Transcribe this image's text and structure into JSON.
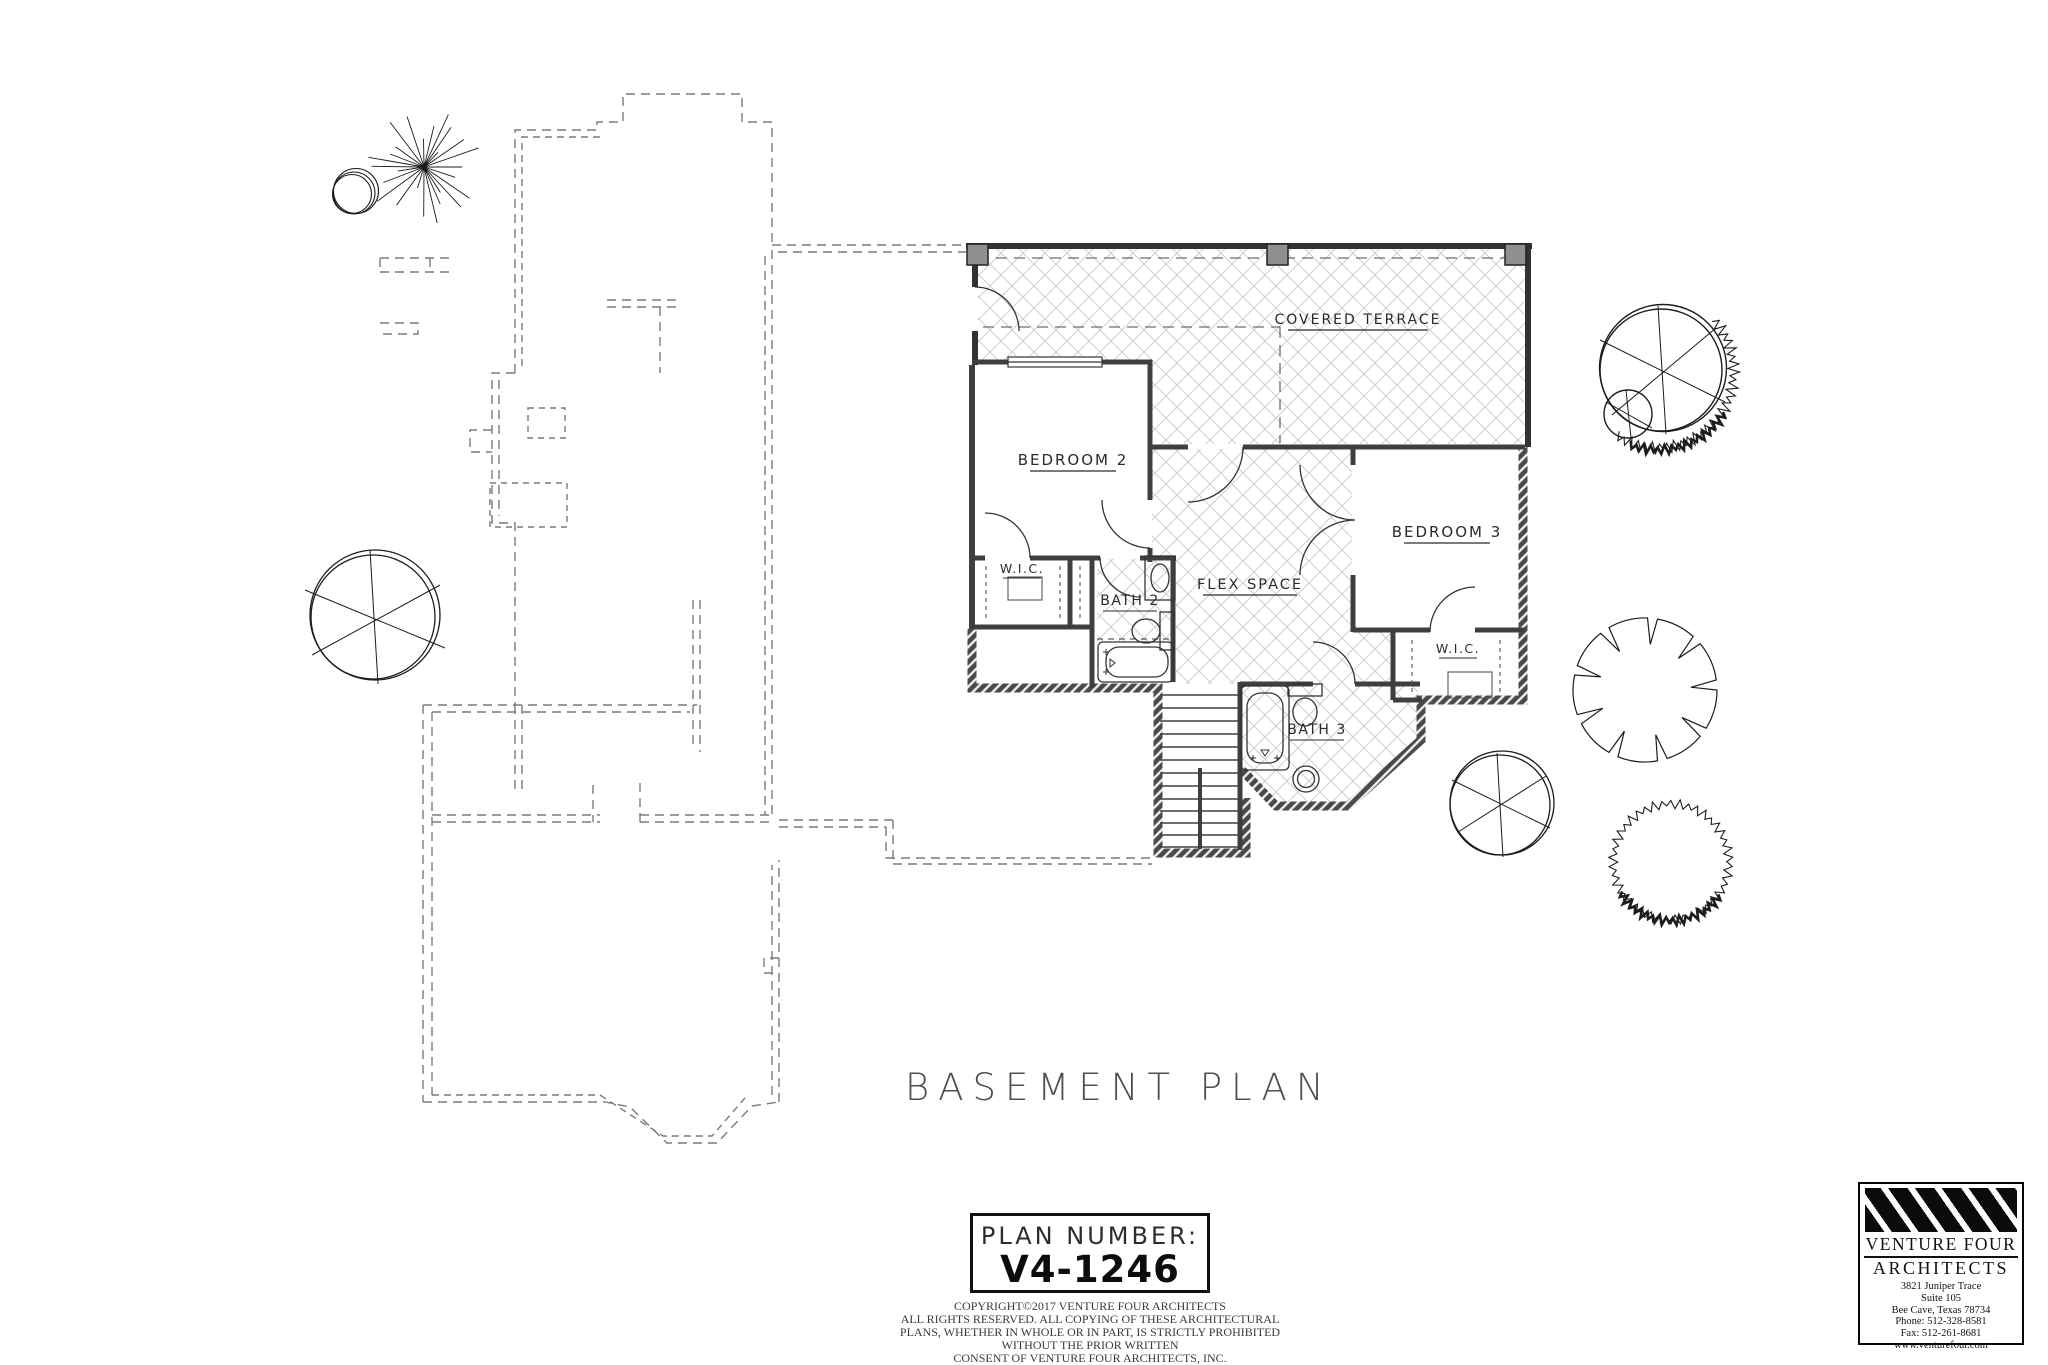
{
  "title": "BASEMENT PLAN",
  "plan_number": {
    "label": "PLAN NUMBER:",
    "value": "V4-1246"
  },
  "rooms": {
    "covered_terrace": "COVERED TERRACE",
    "bedroom2": "BEDROOM 2",
    "bedroom3": "BEDROOM 3",
    "wic_left": "W.I.C.",
    "wic_right": "W.I.C.",
    "bath2": "BATH 2",
    "bath3": "BATH 3",
    "flex_space": "FLEX SPACE"
  },
  "copyright": {
    "lines": [
      "COPYRIGHT©2017 VENTURE FOUR ARCHITECTS",
      "ALL RIGHTS RESERVED. ALL COPYING OF THESE ARCHITECTURAL",
      "PLANS, WHETHER IN WHOLE OR IN PART, IS STRICTLY PROHIBITED",
      "WITHOUT THE PRIOR WRITTEN",
      "CONSENT OF VENTURE FOUR ARCHITECTS, INC."
    ]
  },
  "architect": {
    "name_line1": "VENTURE FOUR",
    "name_line2": "ARCHITECTS",
    "address1": "3821 Juniper Trace",
    "address2": "Suite 105",
    "address3": "Bee Cave, Texas 78734",
    "phone": "Phone: 512-328-8581",
    "fax": "Fax: 512-261-8681",
    "website": "www.venturefour.com"
  },
  "colors": {
    "wall": "#3f3f3f",
    "exterior_wall": "#4a4a4a",
    "hatch": "#c9c9c9",
    "dashed": "#7a7a7a",
    "text": "#2b2b2b"
  }
}
